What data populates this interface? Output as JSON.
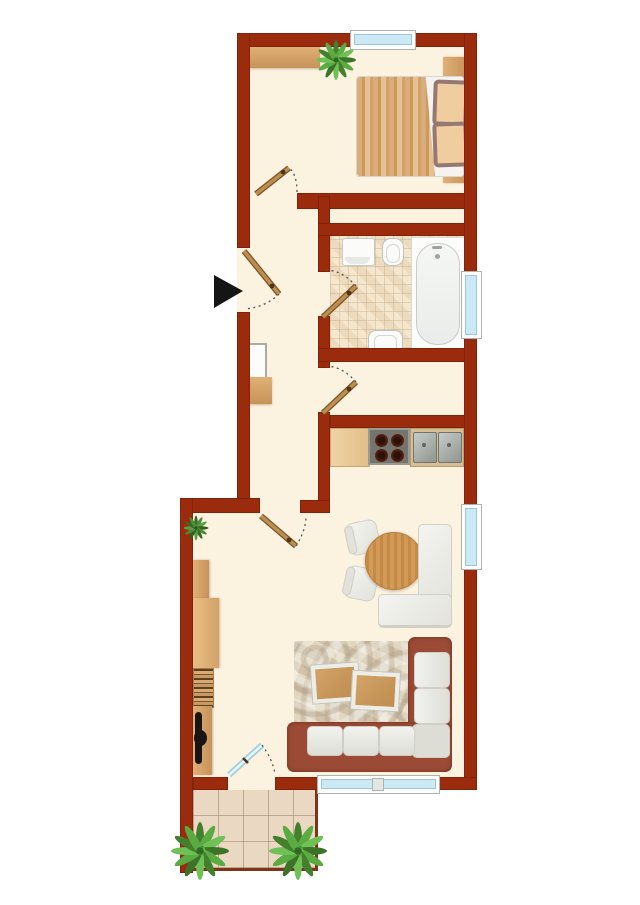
{
  "palette": {
    "wall": "#9A2B0D",
    "floor": "#FBF2E0",
    "window_frame": "#FFFFFF",
    "window_glass": "#CBE9F5",
    "balcony_tile": "#EAD8C2",
    "rail": "#7E3418",
    "door_wood": "#AE7E43",
    "arrow": "#151515",
    "sofa_frame": "#9B4B35",
    "plant_green": "#4E9B3A"
  },
  "plan": {
    "type": "apartment-floor-plan",
    "entrance_arrow": true,
    "window_count": 4,
    "door_count": 6,
    "rooms": [
      {
        "name": "bedroom",
        "furniture": [
          "wardrobe",
          "plant",
          "double-bed",
          "headboard",
          "pillows"
        ]
      },
      {
        "name": "hallway",
        "furniture": [
          "mirror",
          "shelf"
        ]
      },
      {
        "name": "bathroom",
        "furniture": [
          "washing-machine",
          "toilet",
          "washbasin",
          "bathtub"
        ]
      },
      {
        "name": "storage-nook",
        "furniture": []
      },
      {
        "name": "kitchen",
        "furniture": [
          "counter",
          "stove",
          "double-sink"
        ]
      },
      {
        "name": "living-dining-room",
        "furniture": [
          "dining-table",
          "chair",
          "chair",
          "corner-bench",
          "cabinet",
          "cabinet",
          "bookshelf",
          "tv-stand",
          "tv",
          "rug",
          "coffee-table",
          "coffee-table",
          "corner-sofa",
          "plant"
        ]
      },
      {
        "name": "balcony",
        "furniture": [
          "plant",
          "plant"
        ]
      }
    ]
  },
  "labels": {
    "wardrobe": "Wardrobe",
    "bed": "Double bed",
    "headboard": "Headboard",
    "washing_machine": "Washing machine",
    "toilet": "Toilet",
    "washbasin": "Washbasin",
    "bathtub": "Bathtub",
    "mirror": "Hall mirror",
    "shelf": "Hall shelf",
    "counter": "Kitchen counter",
    "stove": "Stove",
    "sink": "Double sink",
    "table": "Dining table",
    "chair": "Chair",
    "bench": "Corner bench",
    "cabinet": "Cabinet",
    "bookshelf": "Bookshelf",
    "tv": "TV",
    "rug": "Rug",
    "coffee_table": "Coffee table",
    "sofa": "Corner sofa",
    "plant": "Plant",
    "balcony": "Balcony",
    "entrance": "Entrance"
  }
}
